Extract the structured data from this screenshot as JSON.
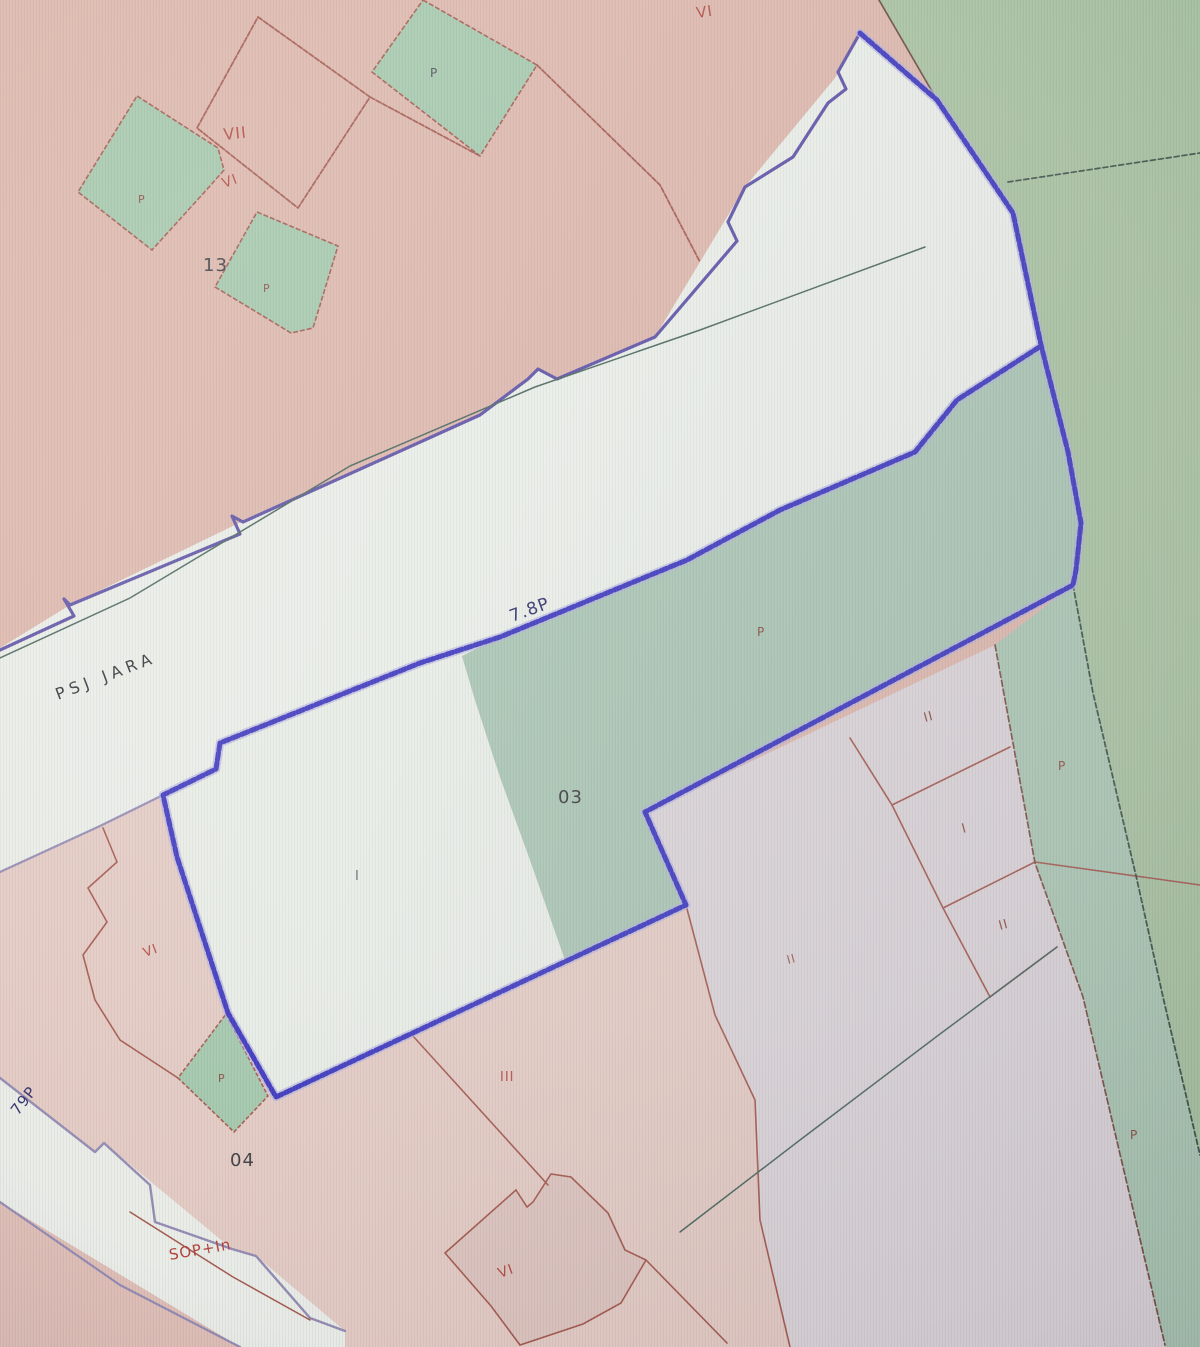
{
  "app": {
    "title": "Cadastral parcel map viewer"
  },
  "map": {
    "canvas": {
      "width": 1200,
      "height": 1347
    },
    "palette": {
      "pink_field": "#dcb6ab",
      "green_field": "#a8c2a0",
      "green_parcel": "#a2c7ab",
      "green_band": "#a8c4b2",
      "green_strip": "#aac6b2",
      "street_white": "#e9ede7",
      "parcel_white": "#e7ece5",
      "pale_pink_south": "#e3cac3",
      "pale_gray_center": "#dad3d7",
      "selection_blue": "#3a35bd",
      "selection_halo": "#b0adde",
      "street_purple": "#5b50a5",
      "street_lavender": "#938ab2",
      "boundary_red": "#a2584d",
      "boundary_dark": "#3c5247",
      "teal_line": "#49655c",
      "label_black": "#3a3a40",
      "label_red": "#b0493f",
      "label_navy": "#2e2e6a"
    },
    "regions": [
      {
        "name": "region-pink-field",
        "points": "0,0 1200,0 1200,1347 0,1347",
        "fill": "#dcb6ab",
        "interact": false
      },
      {
        "name": "region-green-northeast",
        "points": "879,0 937,100 1013,213 1041,345 1068,452 1081,523 1076,570 1073,585 1093,693 1137,880 1163,997 1200,1155 1200,0",
        "fill": "#a8c2a0",
        "interact": true
      },
      {
        "name": "region-street-band",
        "points": "0,648 70,605 235,525 480,415 538,369 557,379 655,337 745,187 835,78 860,33 937,100 1013,213 1041,346 957,400 915,452 780,510 687,560 500,637 462,656 420,663 220,743 216,769 163,795 100,826 0,872",
        "fill": "#e9ede7",
        "interact": true
      },
      {
        "name": "region-parcel-white",
        "points": "220,743 420,663 462,656 475,700 500,777 530,860 565,960 276,1097 228,1013 177,857 163,795 216,769",
        "fill": "#e7ece5",
        "interact": true
      },
      {
        "name": "region-green-03",
        "points": "1041,346 957,400 915,452 780,510 687,560 500,637 462,656 475,700 500,777 530,860 565,960 686,905 645,812 1073,585 1076,570 1081,523 1068,452",
        "fill": "#a8c4b2",
        "interact": true
      },
      {
        "name": "region-pink-south",
        "points": "0,872 100,826 163,795 177,857 228,1013 276,1097 686,905 715,1015 755,1100 760,1220 790,1347 0,1347",
        "fill": "#e3cac3",
        "interact": true
      },
      {
        "name": "region-pale-center",
        "points": "645,812 995,645 1035,863 1083,997 1165,1345 1165,1347 790,1347 760,1220 755,1100 715,1015 686,905",
        "fill": "#dad3d7",
        "interact": true
      },
      {
        "name": "region-green-strip",
        "points": "995,645 1073,585 1093,693 1137,880 1163,997 1200,1155 1200,1347 1165,1347 1083,997 1035,863",
        "fill": "#aac6b2",
        "interact": true
      },
      {
        "name": "region-green-parcel-top",
        "points": "423,0 537,65 480,156 372,72",
        "fill": "#a2c7ab",
        "stroke": "#a2584d",
        "sw": 1.6,
        "dash": "5 2",
        "interact": true
      },
      {
        "name": "region-green-parcel-west",
        "points": "137,96 218,148 224,170 210,186 152,250 78,192",
        "fill": "#a2c7ab",
        "stroke": "#a2584d",
        "sw": 1.6,
        "dash": "5 2",
        "interact": true
      },
      {
        "name": "region-green-parcel-13",
        "points": "257,212 338,246 313,328 291,333 215,287",
        "fill": "#a2c7ab",
        "stroke": "#a2584d",
        "sw": 1.6,
        "dash": "5 2",
        "interact": true
      },
      {
        "name": "region-green-parcel-bottom",
        "points": "226,1014 268,1096 234,1132 178,1078",
        "fill": "#a2c7ab",
        "stroke": "#a2584d",
        "sw": 1.6,
        "dash": "4 2",
        "interact": true
      },
      {
        "name": "region-street-band-southwest",
        "points": "0,1078 95,1152 104,1143 232,1249 256,1256 345,1331 345,1347 240,1347 0,1202",
        "fill": "#e9ece7",
        "interact": true
      },
      {
        "name": "region-pink-below-band",
        "points": "0,1202 240,1347 0,1347",
        "fill": "#debeb6",
        "interact": false
      },
      {
        "name": "region-building-footprint",
        "points": "516,1190 527,1207 533,1202 551,1174 571,1177 608,1213 625,1250 646,1260 621,1303 583,1324 520,1345 491,1306 445,1253",
        "fill": "#dcc3bd",
        "stroke": "#a2584d",
        "sw": 1.6,
        "interact": true
      }
    ],
    "lines": [
      {
        "name": "line-street-nw-edge",
        "points": "860,33 838,72 846,89 828,103 793,157 745,187 728,222 737,241 655,337 557,379 538,369 528,379 480,415 243,522 232,516 240,534 70,605 64,599 74,616 0,650",
        "stroke": "#5b50a5",
        "w": 3.2
      },
      {
        "name": "line-street-inner-teal",
        "points": "925,247 700,330 535,387 350,466 130,598 0,658",
        "stroke": "#49655c",
        "w": 1.5
      },
      {
        "name": "line-street-south-west",
        "points": "163,795 100,826 0,872",
        "stroke": "#938ab2",
        "w": 2.2
      },
      {
        "name": "line-parcel-vii",
        "points": "258,17 370,97 298,208 197,128 258,17",
        "stroke": "#a2584d",
        "w": 1.8,
        "dash": "5 2"
      },
      {
        "name": "line-parcel-vii-ne",
        "points": "370,97 480,156",
        "stroke": "#a2584d",
        "w": 1.8,
        "dash": "5 2"
      },
      {
        "name": "line-top-diagonal-red",
        "points": "537,65 660,185 700,262",
        "stroke": "#a2584d",
        "w": 1.8,
        "dash": "5 2"
      },
      {
        "name": "line-pink-green-divide-top",
        "points": "879,0 937,100",
        "stroke": "#6b4a42",
        "w": 1.7
      },
      {
        "name": "line-green-top-divider",
        "points": "1008,182 1200,153",
        "stroke": "#3c5247",
        "w": 1.7,
        "dash": "5 3"
      },
      {
        "name": "line-vi-west-steps",
        "points": "103,828 117,862 88,888 107,922 83,955 95,1000 120,1040 178,1078",
        "stroke": "#a2584d",
        "w": 1.6
      },
      {
        "name": "line-iii-boundary",
        "points": "412,1035 548,1185",
        "stroke": "#a2584d",
        "w": 1.6
      },
      {
        "name": "line-footprint-tail",
        "points": "646,1260 727,1343",
        "stroke": "#a2584d",
        "w": 1.6
      },
      {
        "name": "line-center-east-boundary",
        "points": "686,905 715,1015 755,1100 760,1220 790,1347",
        "stroke": "#a2584d",
        "w": 1.6
      },
      {
        "name": "line-parcels-sw",
        "points": "850,738 892,805 943,908 990,997",
        "stroke": "#a2584d",
        "w": 1.6
      },
      {
        "name": "line-parcel-div-1",
        "points": "892,805 1010,747",
        "stroke": "#a2584d",
        "w": 1.6
      },
      {
        "name": "line-parcel-div-2",
        "points": "943,908 1035,862",
        "stroke": "#a2584d",
        "w": 1.6
      },
      {
        "name": "line-parcel-div-3",
        "points": "990,997 1057,947",
        "stroke": "#a2584d",
        "w": 1.6
      },
      {
        "name": "line-strip-divider",
        "points": "1035,862 1200,885",
        "stroke": "#a2584d",
        "w": 1.5
      },
      {
        "name": "line-teal-bottom",
        "points": "1057,947 940,1034 800,1140 680,1232",
        "stroke": "#49655c",
        "w": 1.5
      },
      {
        "name": "line-strip-west-edge",
        "points": "995,645 1035,863 1083,997 1165,1345",
        "stroke": "#7a4f45",
        "w": 1.7,
        "dash": "6 3"
      },
      {
        "name": "line-strip-east-edge",
        "points": "1073,585 1093,693 1137,880 1163,997 1200,1155",
        "stroke": "#3c5247",
        "w": 1.8,
        "dash": "5 3"
      },
      {
        "name": "line-band-sw-upper-edge",
        "points": "0,1078 95,1152 104,1143 150,1185 155,1222 232,1249 256,1256 310,1318 345,1331",
        "stroke": "#938ab2",
        "w": 2.4
      },
      {
        "name": "line-band-sw-lower-edge",
        "points": "0,1202 120,1285 240,1347",
        "stroke": "#938ab2",
        "w": 2.2
      },
      {
        "name": "line-band-sw-red",
        "points": "130,1212 233,1277 310,1320",
        "stroke": "#a2584d",
        "w": 1.5
      },
      {
        "name": "line-selection-blue",
        "points": "860,33 937,100 1013,213 1041,345 1068,452 1081,523 1076,570 1073,585 645,812 686,905 276,1097 228,1013 177,857 163,795 216,769 220,743 420,663 500,637 687,560 780,510 915,452 957,400 1041,346",
        "stroke": "#3a35bd",
        "w": 5,
        "dash": "7 3",
        "halo": true
      }
    ],
    "labels": [
      {
        "name": "label-vi-top-field",
        "text": "VI",
        "x": 697,
        "y": 18,
        "size": 15,
        "color": "#b0493f",
        "rot": -8
      },
      {
        "name": "label-p-top-parcel",
        "text": "P",
        "x": 430,
        "y": 77,
        "size": 12,
        "color": "#4a4a55",
        "rot": 0
      },
      {
        "name": "label-vii",
        "text": "VII",
        "x": 224,
        "y": 140,
        "size": 16,
        "color": "#b0493f",
        "rot": -6
      },
      {
        "name": "label-vi-upper",
        "text": "VI",
        "x": 224,
        "y": 188,
        "size": 14,
        "color": "#b0493f",
        "rot": -20
      },
      {
        "name": "label-p-west-parcel",
        "text": "P",
        "x": 138,
        "y": 203,
        "size": 11,
        "color": "#8a4a42",
        "rot": 0
      },
      {
        "name": "label-13",
        "text": "13",
        "x": 203,
        "y": 271,
        "size": 18,
        "color": "#3a3a40",
        "rot": 0
      },
      {
        "name": "label-p-13-parcel",
        "text": "P",
        "x": 263,
        "y": 292,
        "size": 11,
        "color": "#8a4a42",
        "rot": 0
      },
      {
        "name": "label-psj-jara",
        "text": "PSJ   JARA",
        "x": 58,
        "y": 700,
        "size": 16,
        "color": "#2f2f35,",
        "rot": -21,
        "ls": 5
      },
      {
        "name": "label-78p",
        "text": "7.8P",
        "x": 512,
        "y": 622,
        "size": 17,
        "color": "#2e2e6a",
        "rot": -20
      },
      {
        "name": "label-p-green-band",
        "text": "P",
        "x": 757,
        "y": 636,
        "size": 12,
        "color": "#8a4a42",
        "rot": 0
      },
      {
        "name": "label-03",
        "text": "03",
        "x": 558,
        "y": 803,
        "size": 18,
        "color": "#3a3a40",
        "rot": 0
      },
      {
        "name": "label-ii-ne",
        "text": "II",
        "x": 925,
        "y": 722,
        "size": 13,
        "color": "#8a4a42",
        "rot": -15
      },
      {
        "name": "label-p-strip-upper",
        "text": "P",
        "x": 1058,
        "y": 770,
        "size": 12,
        "color": "#8a4a42",
        "rot": 0
      },
      {
        "name": "label-i-east",
        "text": "I",
        "x": 963,
        "y": 833,
        "size": 13,
        "color": "#8a4a42",
        "rot": -15
      },
      {
        "name": "label-i-parcel-white",
        "text": "I",
        "x": 355,
        "y": 880,
        "size": 13,
        "color": "#6a6a72",
        "rot": 0
      },
      {
        "name": "label-ii-east-lower",
        "text": "II",
        "x": 1000,
        "y": 930,
        "size": 13,
        "color": "#8a4a42",
        "rot": -15
      },
      {
        "name": "label-vi-west",
        "text": "VI",
        "x": 145,
        "y": 957,
        "size": 13,
        "color": "#b0493f",
        "rot": -20
      },
      {
        "name": "label-ii-center",
        "text": "II",
        "x": 788,
        "y": 964,
        "size": 12,
        "color": "#9a5a52",
        "rot": -15
      },
      {
        "name": "label-iii",
        "text": "III",
        "x": 500,
        "y": 1081,
        "size": 13,
        "color": "#b0493f",
        "rot": 0
      },
      {
        "name": "label-p-bottom-diamond",
        "text": "P",
        "x": 218,
        "y": 1082,
        "size": 11,
        "color": "#8a4a42",
        "rot": 0
      },
      {
        "name": "label-79p",
        "text": "79P",
        "x": 18,
        "y": 1116,
        "size": 15,
        "color": "#2e2e6a",
        "rot": -52
      },
      {
        "name": "label-p-strip-lower",
        "text": "P",
        "x": 1130,
        "y": 1139,
        "size": 12,
        "color": "#8a4a42",
        "rot": 0
      },
      {
        "name": "label-04",
        "text": "04",
        "x": 230,
        "y": 1166,
        "size": 18,
        "color": "#3a3a40",
        "rot": 0
      },
      {
        "name": "label-sop-in",
        "text": "SOP+In",
        "x": 170,
        "y": 1260,
        "size": 15,
        "color": "#b0403a",
        "rot": -10
      },
      {
        "name": "label-vi-bottom",
        "text": "VI",
        "x": 500,
        "y": 1278,
        "size": 14,
        "color": "#b0493f",
        "rot": -20
      }
    ]
  }
}
